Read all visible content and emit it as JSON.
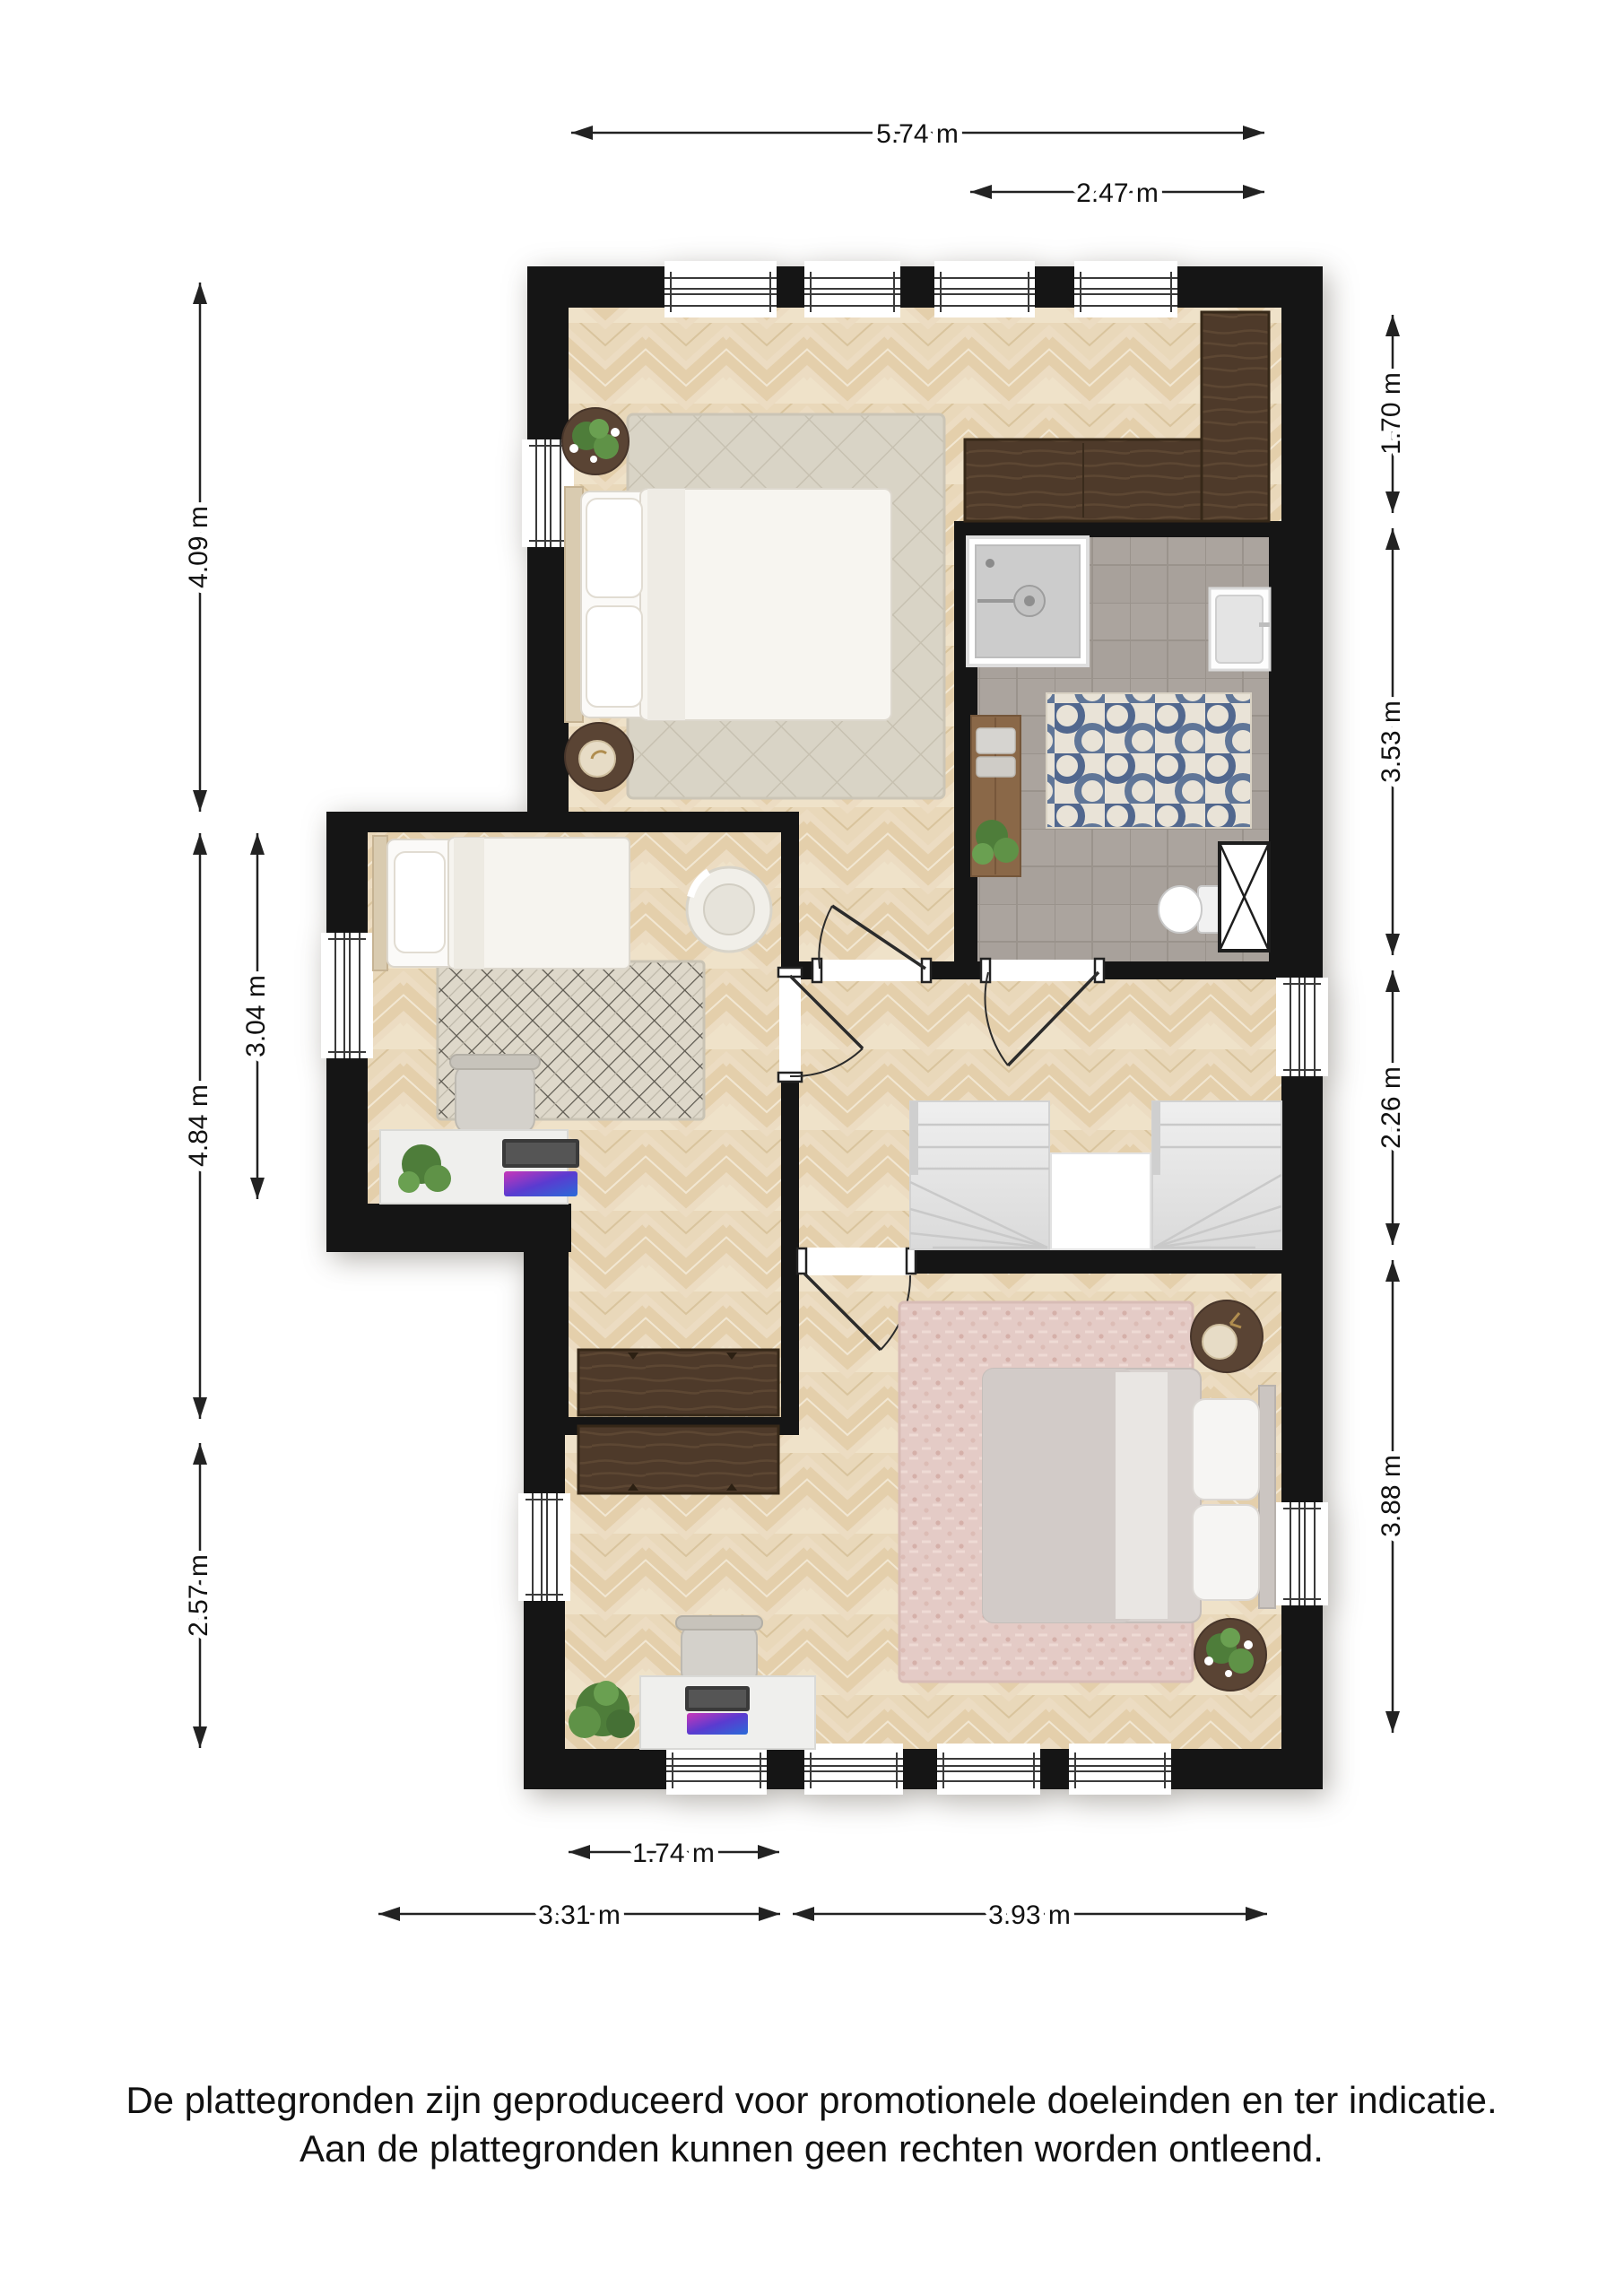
{
  "document": {
    "type": "floor-plan",
    "language": "nl",
    "footer": {
      "line1": "De plattegronden zijn geproduceerd voor promotionele doeleinden en ter indicatie.",
      "line2": "Aan de plattegronden kunnen geen rechten worden ontleend."
    }
  },
  "dimensions": {
    "top": [
      {
        "id": "top-width",
        "label": "5.74 m"
      },
      {
        "id": "bathroom-width",
        "label": "2.47 m"
      }
    ],
    "left": [
      {
        "id": "bedroom-top-depth",
        "label": "4.09 m"
      },
      {
        "id": "bedroom-middle-depth",
        "label": "3.04 m"
      },
      {
        "id": "left-extension-depth",
        "label": "4.84 m"
      },
      {
        "id": "bottom-left-depth",
        "label": "2.57 m"
      }
    ],
    "right": [
      {
        "id": "wardrobe-nook-depth",
        "label": "1.70 m"
      },
      {
        "id": "bathroom-depth",
        "label": "3.53 m"
      },
      {
        "id": "landing-depth",
        "label": "2.26 m"
      },
      {
        "id": "bedroom-bottom-depth",
        "label": "3.88 m"
      }
    ],
    "bottom": [
      {
        "id": "left-arm-width",
        "label": "1.74 m"
      },
      {
        "id": "bottom-left-width",
        "label": "3.31 m"
      },
      {
        "id": "bottom-right-width",
        "label": "3.93 m"
      }
    ]
  },
  "floorplan": {
    "rooms": [
      {
        "name": "bedroom-top",
        "floor": "parquet"
      },
      {
        "name": "bathroom",
        "floor": "grey-tile"
      },
      {
        "name": "bedroom-middle",
        "floor": "parquet"
      },
      {
        "name": "landing",
        "floor": "parquet"
      },
      {
        "name": "bedroom-bottom",
        "floor": "parquet"
      }
    ],
    "colors": {
      "wall": "#151515",
      "parquet_light": "#ecdcc2",
      "parquet_dark": "#e4cfab",
      "tile": "#a8a19b",
      "dark_wood": "#4b3829",
      "rug_neutral": "#d9d4c6",
      "rug_pattern_dark": "#57534a",
      "rug_blue_accent": "#51678e",
      "rug_pink": "#e4cbc6",
      "dimension_line": "#222222"
    }
  }
}
